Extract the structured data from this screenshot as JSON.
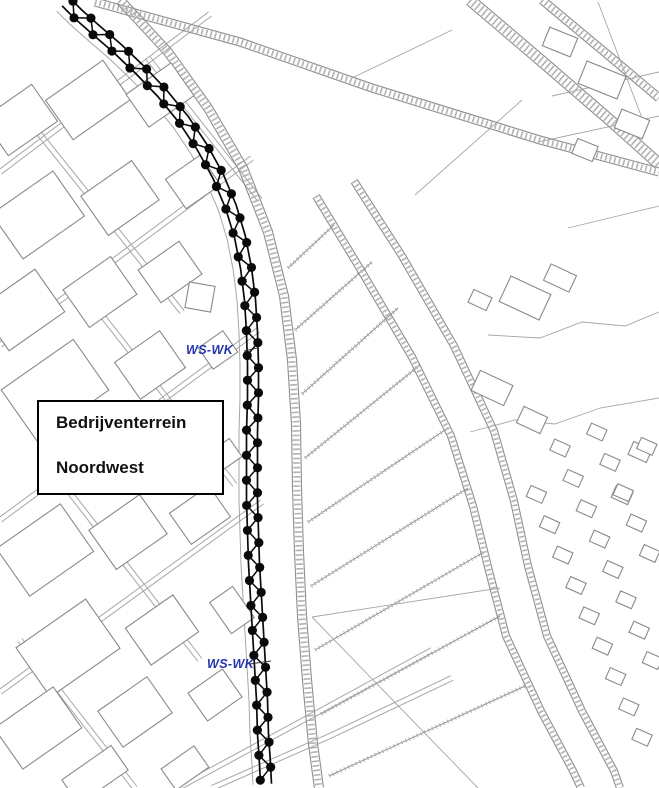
{
  "area_label": {
    "line1": "Bedrijventerrein",
    "line2": "Noordwest"
  },
  "zone_labels": [
    {
      "text": "WS-WK",
      "x": 186,
      "y": 343,
      "leader": [
        244,
        351,
        258,
        348
      ]
    },
    {
      "text": "WS-WK",
      "x": 207,
      "y": 657,
      "leader": [
        250,
        664,
        271,
        661
      ]
    }
  ],
  "colors": {
    "background": "#ffffff",
    "map_line": "#8f8f8f",
    "map_line_faint": "#a6a6a6",
    "hatch": "#b2b2b2",
    "building_line": "#8a8a8a",
    "boundary_black": "#0a0a0a",
    "zone_label_blue": "#2335ad",
    "box_border": "#000000"
  },
  "boundary_chain": {
    "midline": [
      66,
      2,
      78,
      14,
      96,
      30,
      118,
      49,
      140,
      70,
      162,
      93,
      184,
      120,
      202,
      147,
      218,
      176,
      231,
      207,
      240,
      237,
      246,
      268,
      250,
      300,
      252,
      332,
      253,
      364,
      253,
      398,
      252,
      432,
      252,
      466,
      252,
      500,
      253,
      532,
      254,
      564,
      256,
      598,
      258,
      632,
      260,
      666,
      262,
      700,
      263,
      734,
      265,
      764,
      266,
      784
    ],
    "rail_offset": 5.5,
    "dot_spacing": 12.5,
    "dot_radius": 4.6
  },
  "map": {
    "hatched_bands": [
      {
        "w": 8,
        "pts": [
          95,
          2,
          240,
          42,
          372,
          88,
          540,
          140,
          659,
          172
        ]
      },
      {
        "w": 9,
        "pts": [
          120,
          0,
          168,
          52,
          208,
          108,
          243,
          168,
          268,
          232,
          284,
          296,
          292,
          360,
          296,
          424,
          297,
          488,
          299,
          552,
          302,
          616,
          307,
          680,
          313,
          744,
          319,
          788
        ]
      },
      {
        "w": 11,
        "pts": [
          470,
          0,
          545,
          64,
          612,
          122,
          659,
          164
        ]
      },
      {
        "w": 8,
        "pts": [
          542,
          0,
          614,
          60,
          659,
          98
        ]
      },
      {
        "w": 7,
        "pts": [
          316,
          196,
          362,
          272,
          412,
          357,
          451,
          436,
          473,
          506,
          489,
          571,
          506,
          636,
          541,
          711,
          573,
          771,
          581,
          788
        ]
      },
      {
        "w": 7,
        "pts": [
          354,
          181,
          402,
          256,
          454,
          346,
          494,
          431,
          514,
          501,
          528,
          566,
          547,
          636,
          582,
          711,
          614,
          771,
          620,
          788
        ]
      }
    ],
    "c2b_index": 5,
    "ditches": [
      [
        288,
        268,
        334,
        225
      ],
      [
        295,
        330,
        372,
        262
      ],
      [
        302,
        394,
        398,
        308
      ],
      [
        305,
        458,
        420,
        365
      ],
      [
        308,
        522,
        448,
        428
      ],
      [
        311,
        586,
        468,
        488
      ],
      [
        315,
        650,
        484,
        552
      ],
      [
        321,
        714,
        500,
        616
      ],
      [
        329,
        776,
        525,
        686
      ]
    ],
    "double_roads": [
      [
        0,
        172,
        210,
        14
      ],
      [
        0,
        345,
        252,
        158
      ],
      [
        0,
        520,
        258,
        330
      ],
      [
        0,
        692,
        262,
        502
      ],
      [
        148,
        58,
        260,
        200
      ],
      [
        30,
        122,
        182,
        312
      ],
      [
        90,
        300,
        235,
        485
      ],
      [
        60,
        480,
        200,
        660
      ],
      [
        20,
        640,
        135,
        788
      ],
      [
        178,
        788,
        300,
        722,
        432,
        650
      ],
      [
        212,
        788,
        330,
        736,
        452,
        678
      ]
    ],
    "thin_lines": [
      [
        470,
        432,
        515,
        420,
        555,
        424,
        600,
        408,
        659,
        398
      ],
      [
        488,
        335,
        540,
        338,
        582,
        322,
        625,
        326,
        659,
        312
      ],
      [
        312,
        617,
        478,
        788
      ],
      [
        312,
        617,
        500,
        588
      ],
      [
        552,
        96,
        659,
        72
      ],
      [
        538,
        142,
        659,
        116
      ],
      [
        568,
        228,
        659,
        206
      ],
      [
        352,
        78,
        452,
        30
      ],
      [
        415,
        195,
        522,
        100
      ],
      [
        598,
        2,
        642,
        118
      ]
    ],
    "buildings": [
      [
        20,
        120,
        60,
        45,
        -35
      ],
      [
        88,
        100,
        70,
        48,
        -35
      ],
      [
        160,
        95,
        55,
        40,
        -35
      ],
      [
        38,
        215,
        75,
        55,
        -35
      ],
      [
        120,
        198,
        62,
        48,
        -35
      ],
      [
        193,
        182,
        42,
        36,
        -35
      ],
      [
        22,
        310,
        68,
        52,
        -35
      ],
      [
        100,
        292,
        58,
        46,
        -35
      ],
      [
        170,
        272,
        50,
        40,
        -35
      ],
      [
        200,
        297,
        26,
        26,
        10
      ],
      [
        55,
        390,
        88,
        62,
        -35
      ],
      [
        150,
        365,
        55,
        45,
        -35
      ],
      [
        218,
        350,
        30,
        26,
        -35
      ],
      [
        45,
        550,
        78,
        58,
        -35
      ],
      [
        128,
        532,
        62,
        48,
        -35
      ],
      [
        200,
        515,
        48,
        38,
        -35
      ],
      [
        68,
        648,
        85,
        60,
        -35
      ],
      [
        162,
        630,
        58,
        45,
        -35
      ],
      [
        38,
        728,
        72,
        50,
        -35
      ],
      [
        135,
        712,
        60,
        44,
        -35
      ],
      [
        215,
        695,
        42,
        34,
        -35
      ],
      [
        95,
        775,
        60,
        30,
        -35
      ],
      [
        185,
        768,
        40,
        26,
        -35
      ],
      [
        225,
        455,
        26,
        22,
        -35
      ],
      [
        232,
        610,
        28,
        38,
        -35
      ],
      [
        560,
        42,
        30,
        20,
        22
      ],
      [
        602,
        80,
        42,
        24,
        22
      ],
      [
        632,
        124,
        30,
        20,
        22
      ],
      [
        585,
        150,
        22,
        16,
        22
      ],
      [
        525,
        298,
        44,
        28,
        25
      ],
      [
        560,
        278,
        28,
        18,
        25
      ],
      [
        492,
        388,
        36,
        22,
        25
      ],
      [
        532,
        420,
        26,
        18,
        25
      ],
      [
        480,
        300,
        20,
        14,
        25
      ],
      [
        640,
        452,
        20,
        14,
        24
      ],
      [
        622,
        495,
        18,
        13,
        24
      ]
    ],
    "houses_grid": {
      "origin": [
        560,
        448
      ],
      "dirA": [
        0.4,
        0.92
      ],
      "stepA": 33,
      "countA": 11,
      "dirB": [
        0.92,
        -0.4
      ],
      "stepB": 40,
      "rows": [
        -1,
        0,
        1,
        2
      ],
      "size": [
        17,
        12
      ],
      "rot": 24,
      "clearance": 20
    },
    "chain_parallel_offset": 13
  }
}
